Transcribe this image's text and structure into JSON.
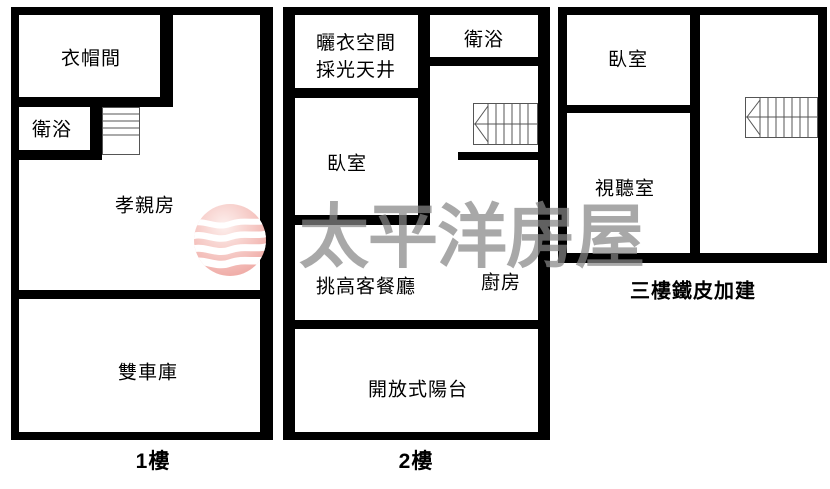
{
  "plan": {
    "floor1": {
      "caption": "1樓",
      "rooms": {
        "closet": "衣帽間",
        "bath": "衛浴",
        "parents_room": "孝親房",
        "garage": "雙車庫"
      }
    },
    "floor2": {
      "caption": "2樓",
      "rooms": {
        "laundry_line1": "曬衣空間",
        "laundry_line2": "採光天井",
        "bath": "衛浴",
        "bedroom": "臥室",
        "living_dining": "挑高客餐廳",
        "kitchen": "廚房",
        "balcony": "開放式陽台"
      }
    },
    "floor3": {
      "caption": "三樓鐵皮加建",
      "rooms": {
        "bedroom": "臥室",
        "av_room": "視聽室"
      }
    }
  },
  "watermark": {
    "brand": "太平洋房屋"
  },
  "colors": {
    "wall": "#000000",
    "watermark_text": "#b2b2b2",
    "logo_pink": "#f3b6b2",
    "stair_line": "#555555"
  }
}
